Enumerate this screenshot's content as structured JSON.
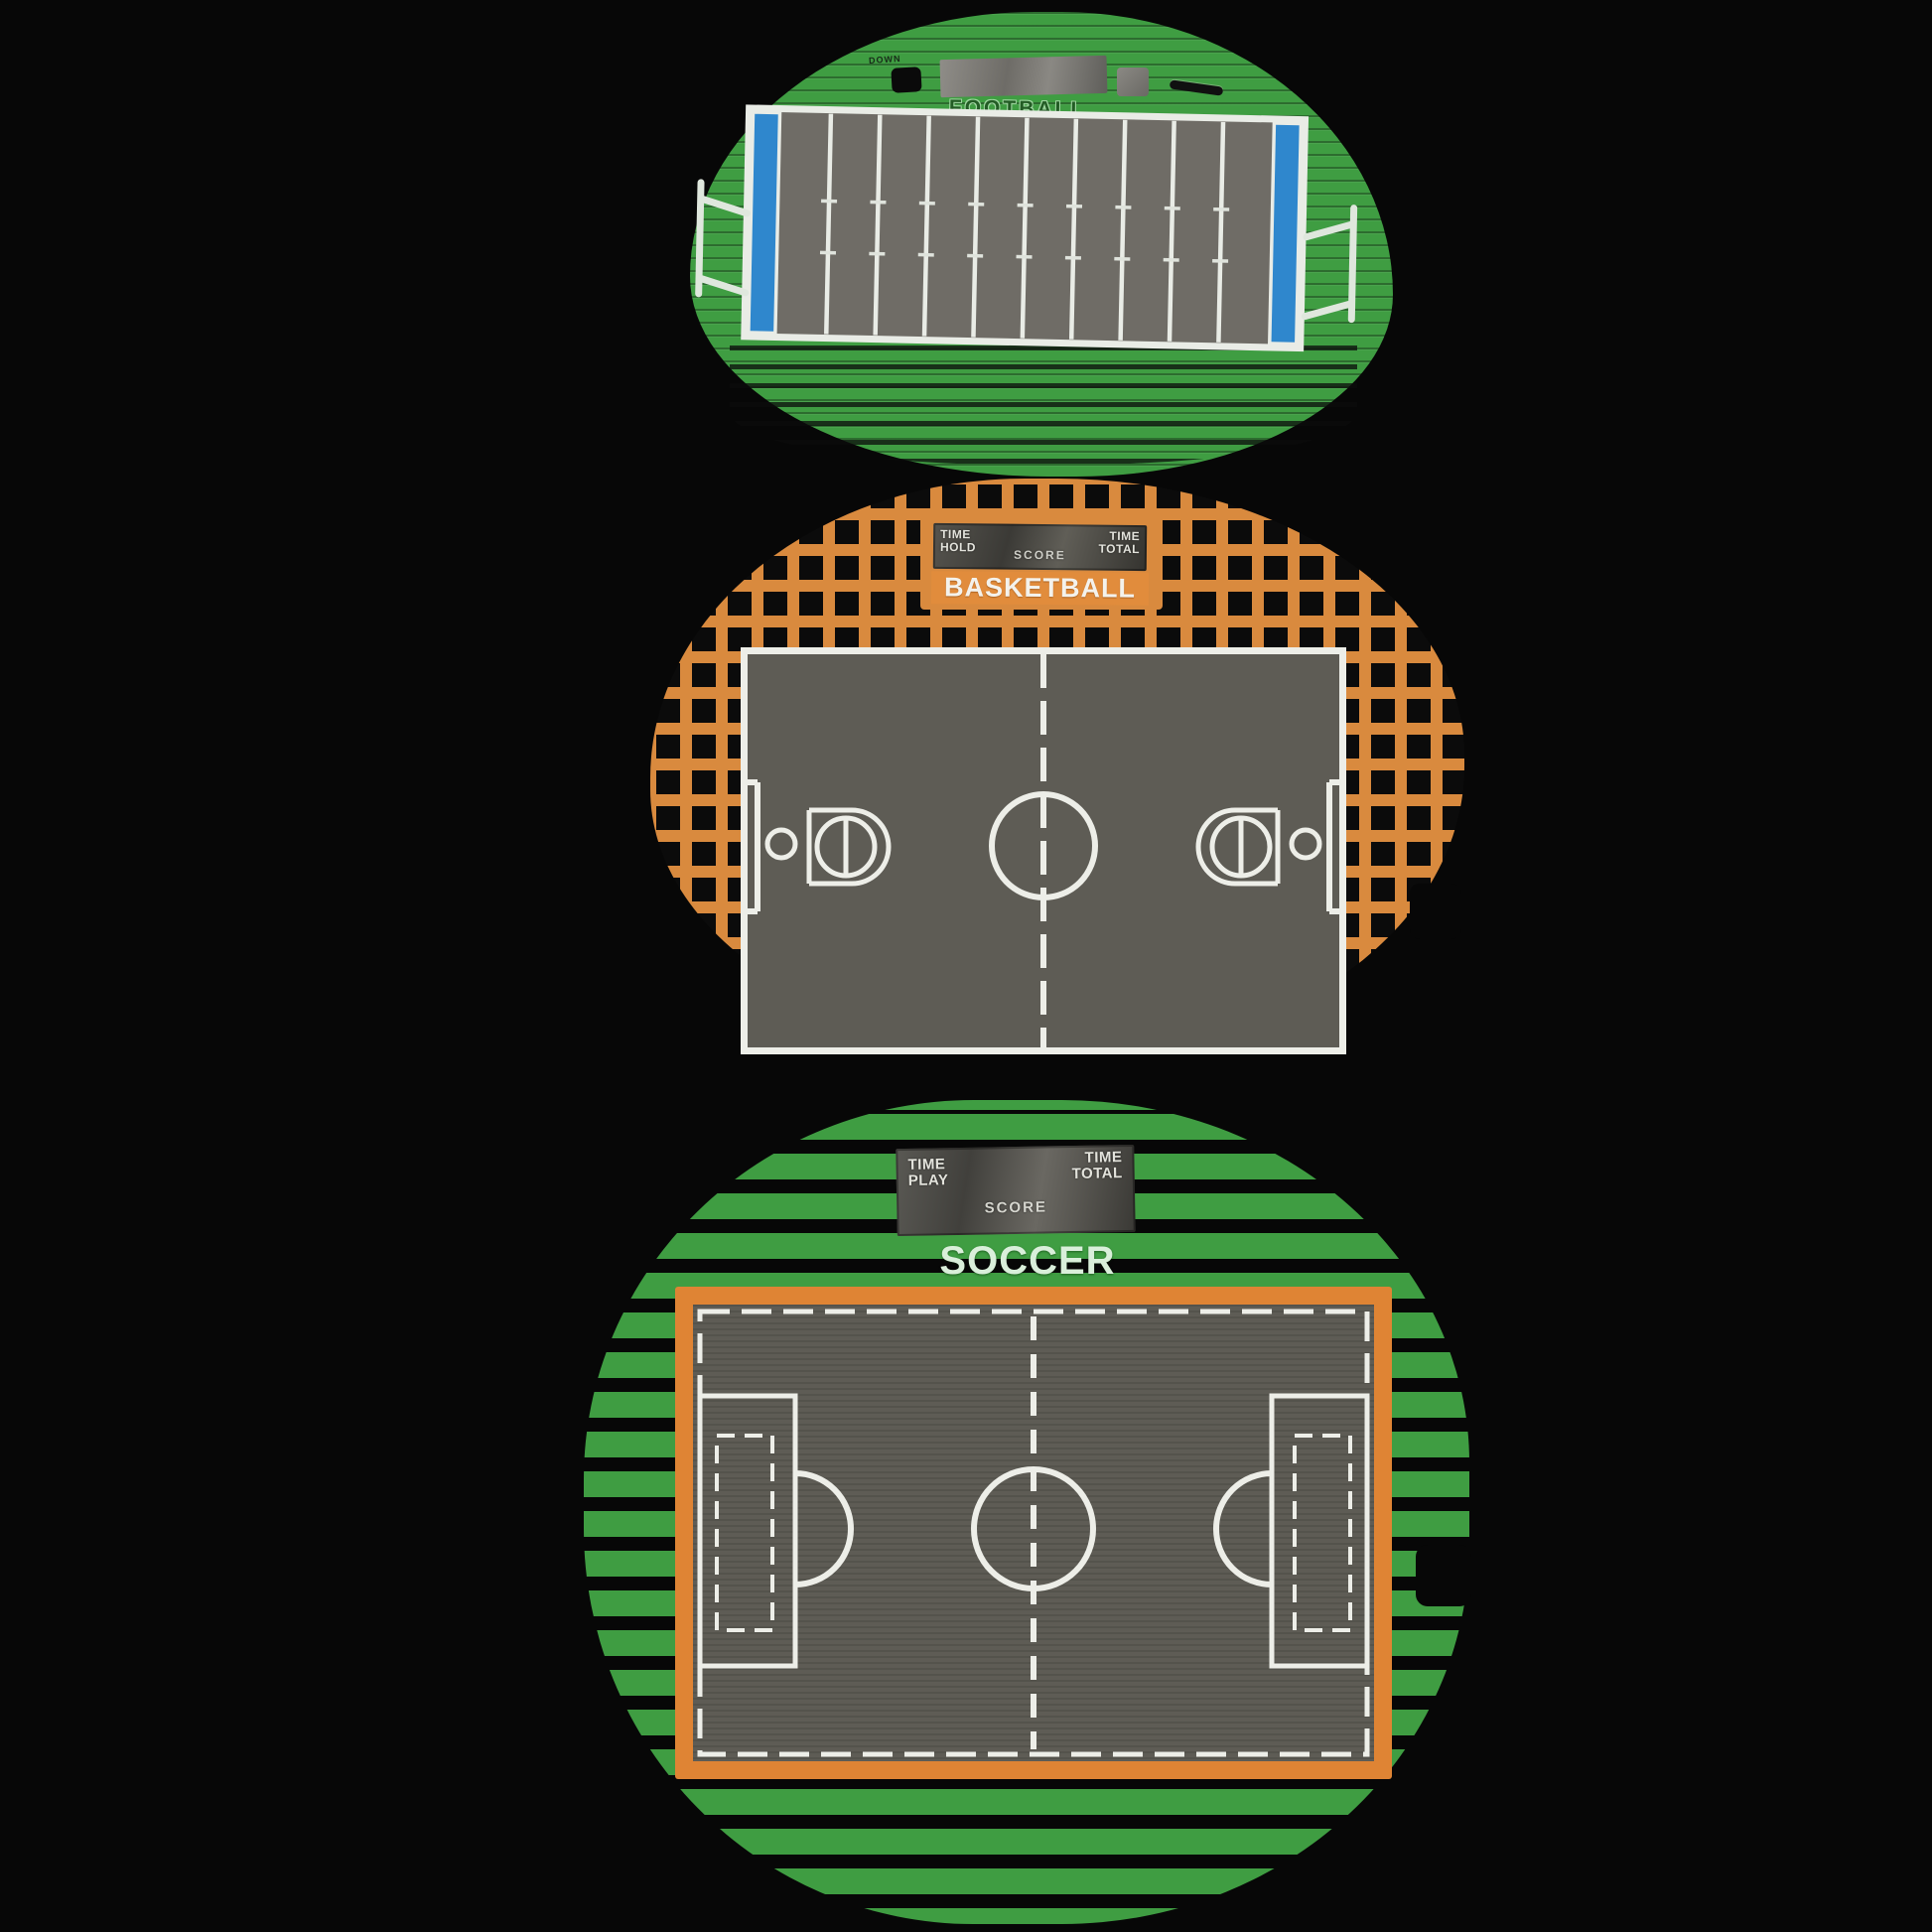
{
  "scene": {
    "description": "Photo of three plastic playfield overlays for a tabletop electronic multi-sport game on a black background",
    "background_color": "#070707"
  },
  "football": {
    "title": "FOOTBALL",
    "down_window_label": "DOWN",
    "colors": {
      "board_green": "#3f9d42",
      "field_gray": "#6f6c66",
      "line_white": "#e9ece6",
      "end_zone_blue": "#2f87cd"
    }
  },
  "basketball": {
    "title": "BASKETBALL",
    "scoreboard": {
      "time_hold": "TIME\nHOLD",
      "score": "SCORE",
      "time_total": "TIME\nTOTAL"
    },
    "colors": {
      "board_orange": "#d98a3e",
      "hole_black": "#0b0b0b",
      "court_gray": "#5e5c55",
      "line_white": "#edeee8",
      "title_text": "#f4f2ec"
    }
  },
  "soccer": {
    "title": "SOCCER",
    "scoreboard": {
      "time_play": "TIME\nPLAY",
      "score": "SCORE",
      "time_total": "TIME\nTOTAL"
    },
    "colors": {
      "board_green": "#3f9d42",
      "slot_black": "#070707",
      "pitch_gray": "#5e5c55",
      "line_white": "#edeee8",
      "border_orange": "#df8434",
      "title_text": "#d9efda"
    }
  }
}
